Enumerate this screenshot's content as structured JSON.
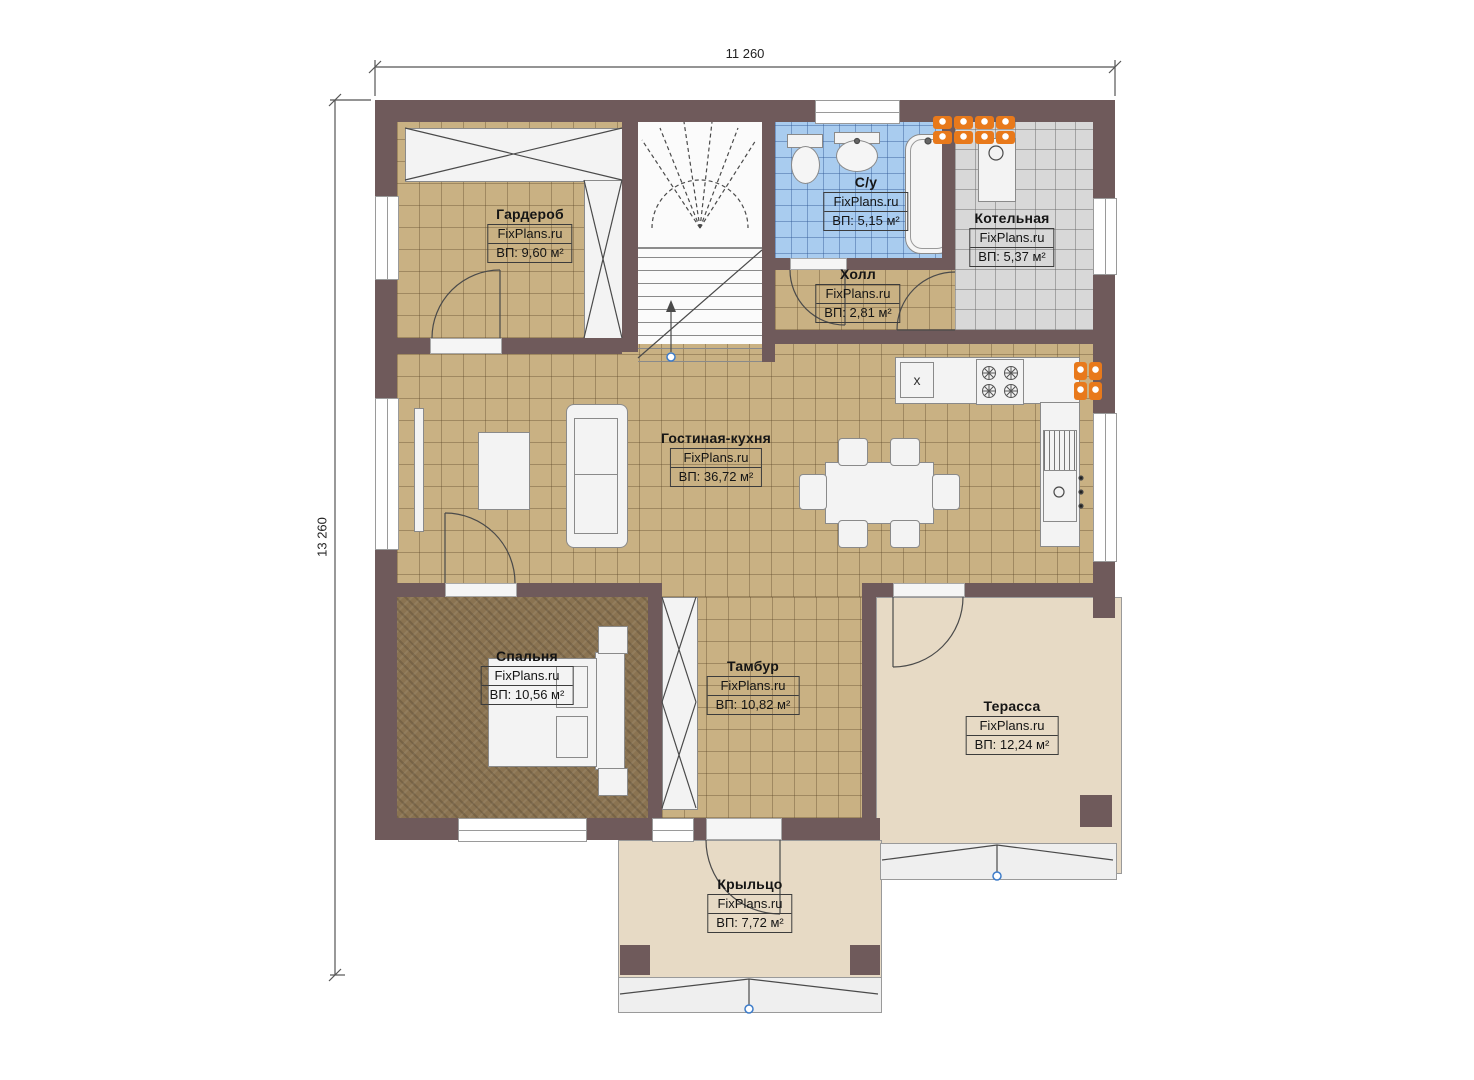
{
  "plan": {
    "title": "floor-plan",
    "brand": "FixPlans.ru",
    "dimensions": {
      "width": "11 260",
      "height": "13 260"
    },
    "rooms": [
      {
        "id": "wardrobe",
        "name": "Гардероб",
        "brand": "FixPlans.ru",
        "area": "ВП: 9,60 м²"
      },
      {
        "id": "bathroom",
        "name": "С/у",
        "brand": "FixPlans.ru",
        "area": "ВП: 5,15 м²"
      },
      {
        "id": "boiler-room",
        "name": "Котельная",
        "brand": "FixPlans.ru",
        "area": "ВП: 5,37 м²"
      },
      {
        "id": "hall",
        "name": "Холл",
        "brand": "FixPlans.ru",
        "area": "ВП: 2,81 м²"
      },
      {
        "id": "living-kitchen",
        "name": "Гостиная-кухня",
        "brand": "FixPlans.ru",
        "area": "ВП: 36,72 м²"
      },
      {
        "id": "bedroom",
        "name": "Спальня",
        "brand": "FixPlans.ru",
        "area": "ВП: 10,56 м²"
      },
      {
        "id": "vestibule",
        "name": "Тамбур",
        "brand": "FixPlans.ru",
        "area": "ВП: 10,82 м²"
      },
      {
        "id": "terrace",
        "name": "Терасса",
        "brand": "FixPlans.ru",
        "area": "ВП: 12,24 м²"
      },
      {
        "id": "porch",
        "name": "Крыльцо",
        "brand": "FixPlans.ru",
        "area": "ВП: 7,72 м²"
      }
    ],
    "kitchen": {
      "sink_symbol": "x"
    },
    "colors": {
      "wall": "#6f5a5b",
      "floor_tile": "#c9b183",
      "bedroom_floor": "#8a7351",
      "bathroom_tile": "#a9ccef",
      "boiler_tile": "#d8d8d8",
      "outdoor_floor": "#e7dac5",
      "radiator": "#e8791b",
      "marker_blue": "#3d7cc9"
    }
  }
}
